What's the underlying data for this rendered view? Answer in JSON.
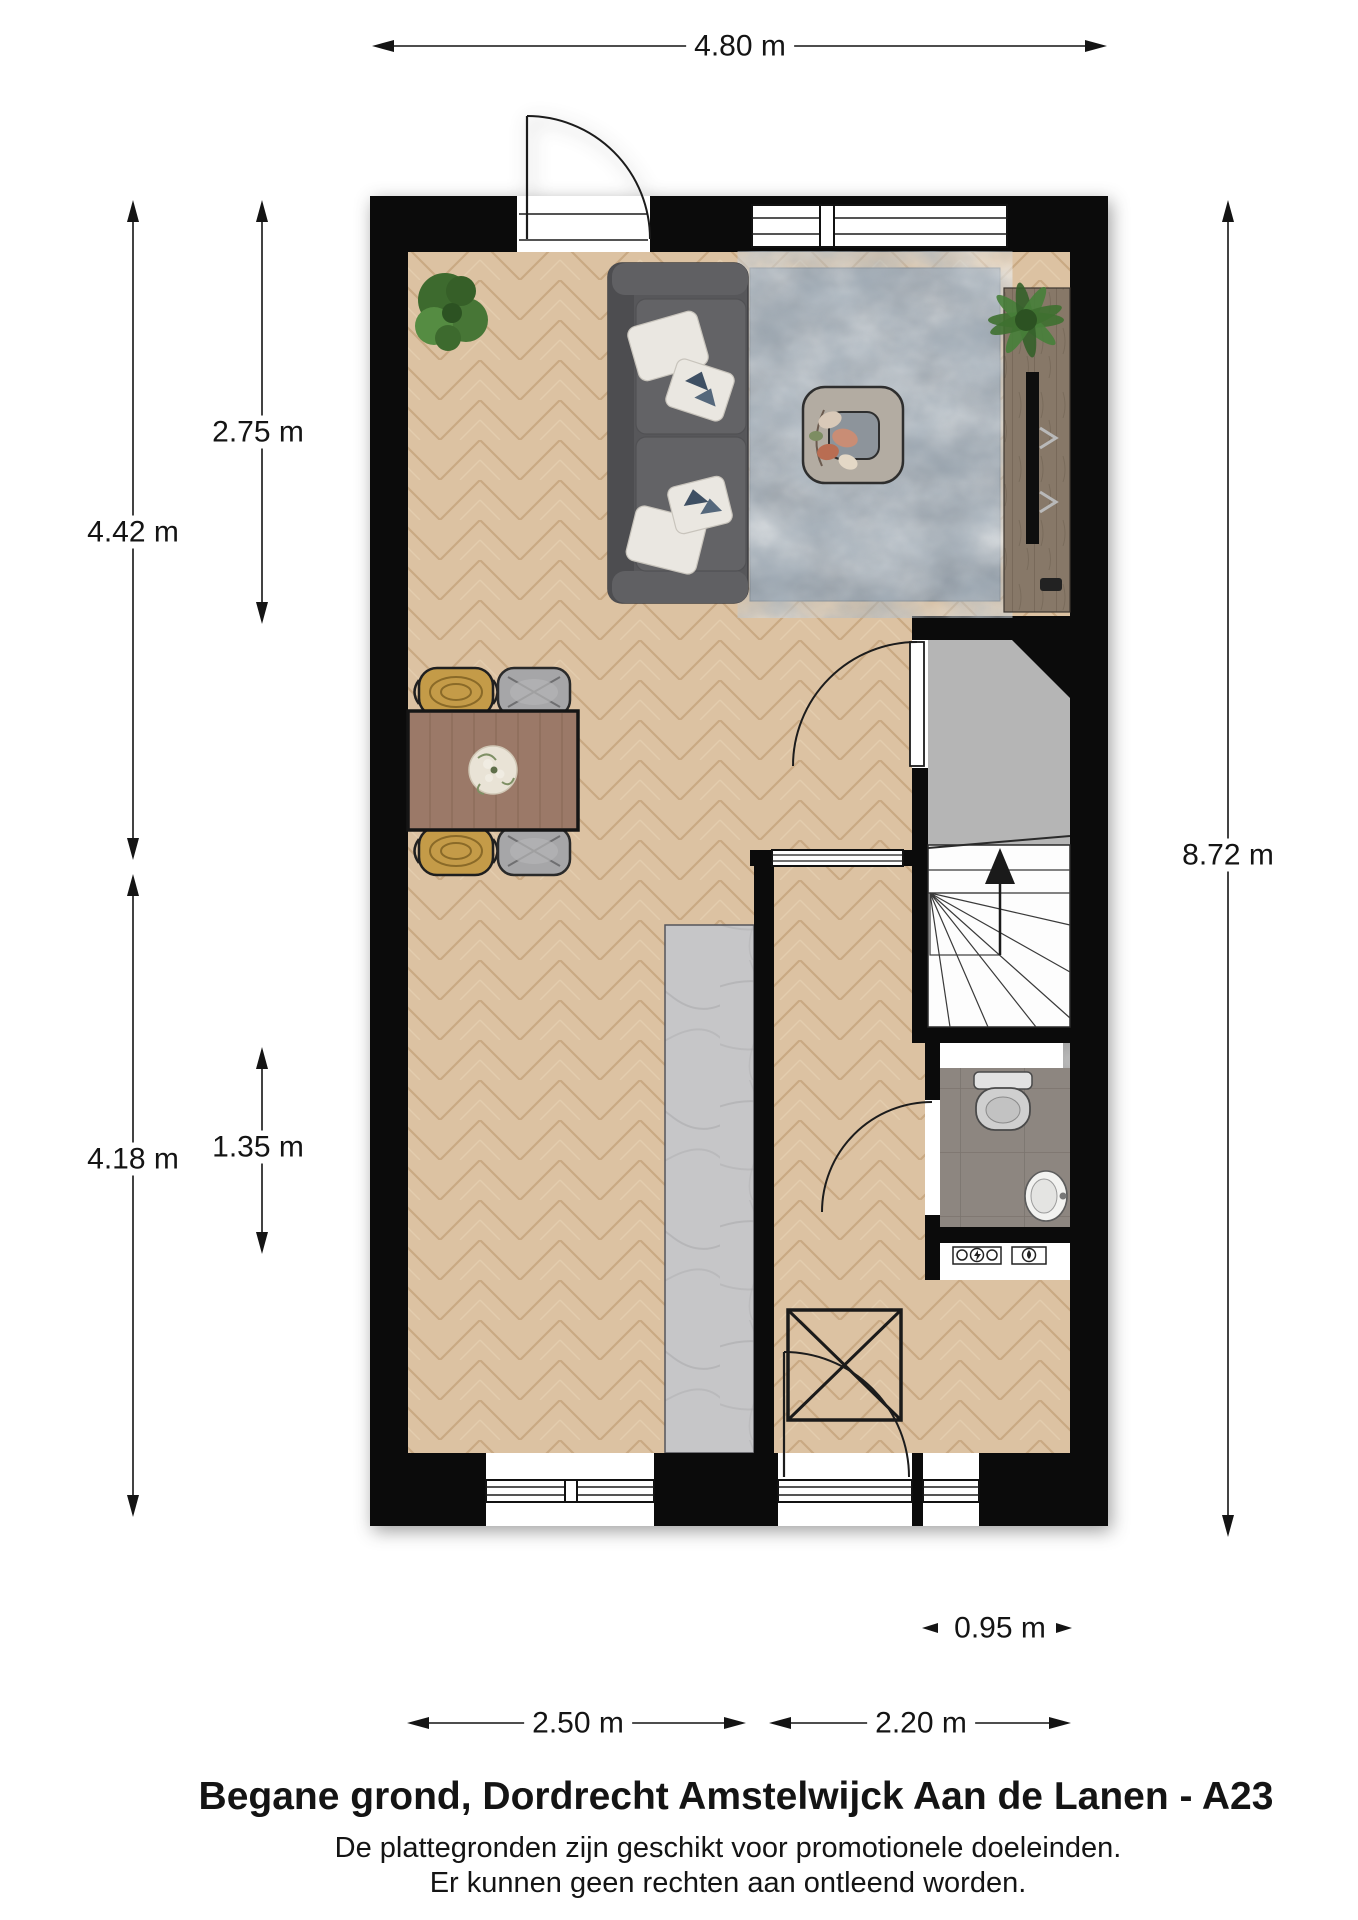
{
  "floorplan": {
    "title": "Begane grond, Dordrecht Amstelwijck Aan de Lanen - A23",
    "disclaimer": {
      "line1": "De plattegronden zijn geschikt voor promotionele doeleinden.",
      "line2": "Er kunnen geen rechten aan ontleend worden."
    },
    "dimensions": {
      "top_width": "4.80 m",
      "left_upper_overall": "4.42 m",
      "left_upper_inner": "2.75 m",
      "left_lower_overall": "4.18 m",
      "left_lower_inner": "1.35 m",
      "right_height": "8.72 m",
      "bottom_left_width": "2.50 m",
      "bottom_right_width": "2.20 m",
      "rear_section_width": "0.95 m"
    },
    "colors": {
      "wall": "#0b0b0b",
      "wood_base": "#dcc2a2",
      "wood_seam": "#c2a078",
      "vestibule": "#b5b5b5",
      "tile_base": "#8d8680",
      "tile_line": "#7b746e",
      "marble": "#c6c6c8",
      "marble_vein": "#b2b2b4",
      "rug_base": "#939ba3",
      "sofa": "#57575a",
      "sofa_cushion": "#636366",
      "pillow": "#eae7e1",
      "table_wood": "#9b7968",
      "rattan": "#c49b48",
      "chair_gray": "#a6a6a8",
      "cabinet": "#877868",
      "plant_dark": "#3d6a2e",
      "plant_light": "#558c42",
      "line_dark": "#1c1c1c",
      "text": "#141414"
    }
  }
}
